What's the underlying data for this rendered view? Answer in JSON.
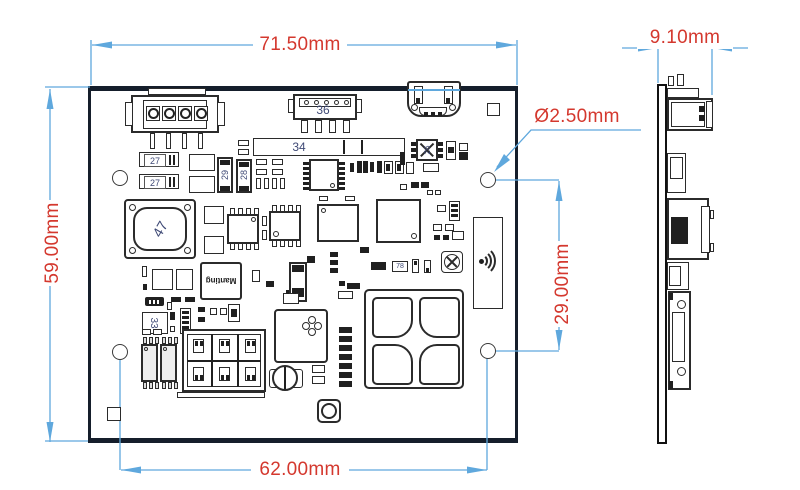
{
  "dimensions": {
    "board_width": "71.50mm",
    "board_height": "59.00mm",
    "hole_spacing_horizontal": "62.00mm",
    "hole_spacing_vertical": "29.00mm",
    "hole_diameter": "Ø2.50mm",
    "side_profile_depth": "9.10mm"
  },
  "silkscreen_labels": {
    "cap_a": "27",
    "cap_b": "27",
    "cap_c": "29",
    "cap_d": "28",
    "module_strip": "34",
    "connector_mid": "36",
    "inductor": "47",
    "ic_small": "26",
    "comp_left": "33",
    "comp_small": "78",
    "module_brand": "Manting"
  },
  "colors": {
    "dimension_line": "#5fa8dd",
    "dimension_text": "#d4382e",
    "board_outline": "#151e2b",
    "component_line": "#2b2b2b"
  }
}
